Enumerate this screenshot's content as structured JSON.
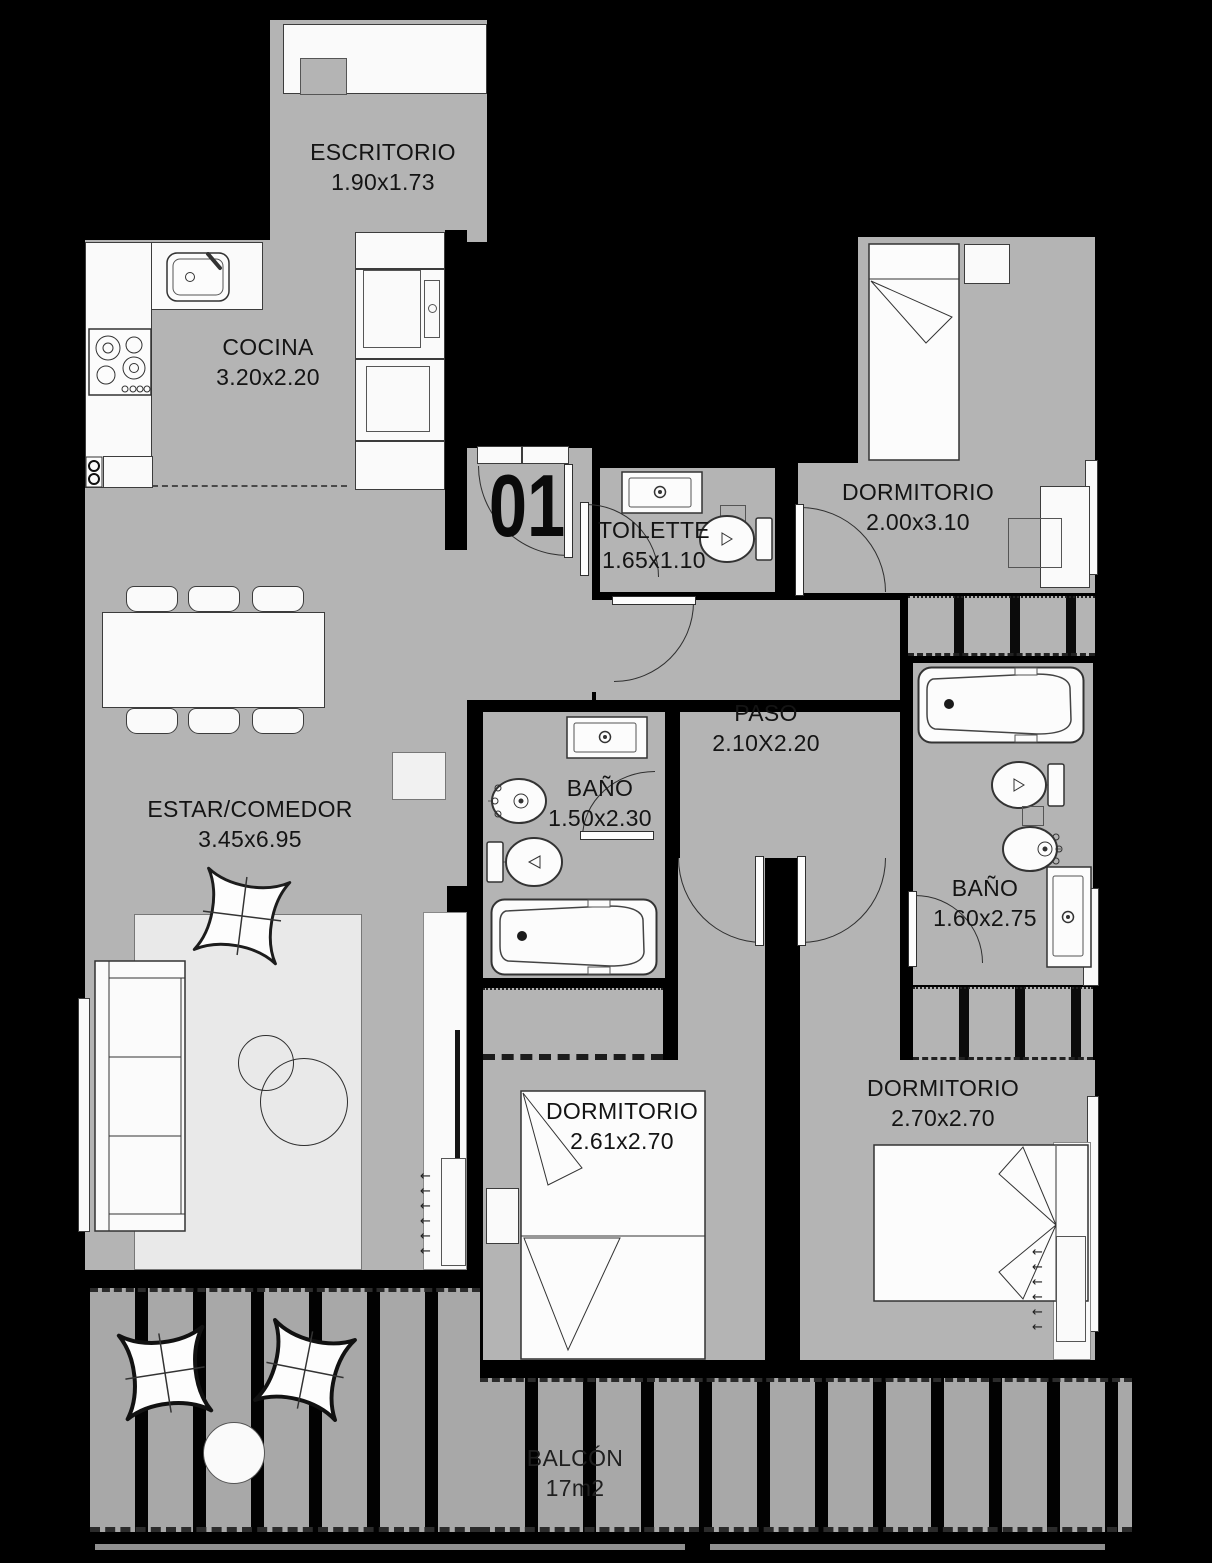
{
  "plan": {
    "unit": "01",
    "rooms": [
      {
        "name": "ESCRITORIO",
        "dims": "1.90x1.73"
      },
      {
        "name": "COCINA",
        "dims": "3.20x2.20"
      },
      {
        "name": "TOILETTE",
        "dims": "1.65x1.10"
      },
      {
        "name": "DORMITORIO",
        "dims": "2.00x3.10"
      },
      {
        "name": "PASO",
        "dims": "2.10X2.20"
      },
      {
        "name": "ESTAR/COMEDOR",
        "dims": "3.45x6.95"
      },
      {
        "name": "BAÑO",
        "dims": "1.50x2.30"
      },
      {
        "name": "BAÑO",
        "dims": "1.60x2.75"
      },
      {
        "name": "DORMITORIO",
        "dims": "2.61x2.70"
      },
      {
        "name": "DORMITORIO",
        "dims": "2.70x2.70"
      },
      {
        "name": "BALCÓN",
        "dims": "17m2"
      }
    ],
    "glyphs": {
      "left_arrow": "←"
    },
    "colors": {
      "background": "#000000",
      "floor": "#b4b4b4",
      "fixture": "#fafafa",
      "outline": "#333333",
      "text": "#151515"
    },
    "fixtures": [
      "desk",
      "kitchen-counter",
      "kitchen-sink",
      "stove",
      "dishwasher",
      "oven-tower",
      "microwave",
      "dining-table",
      "dining-chairs",
      "sofa",
      "armchair",
      "coffee-tables",
      "rug",
      "tv-unit",
      "tv",
      "vent-unit",
      "vanity-sink",
      "toilet",
      "bidet",
      "bathtub",
      "single-bed",
      "double-bed",
      "nightstand",
      "wardrobe",
      "door",
      "window",
      "deck-planks",
      "outdoor-armchairs",
      "outdoor-table"
    ]
  }
}
